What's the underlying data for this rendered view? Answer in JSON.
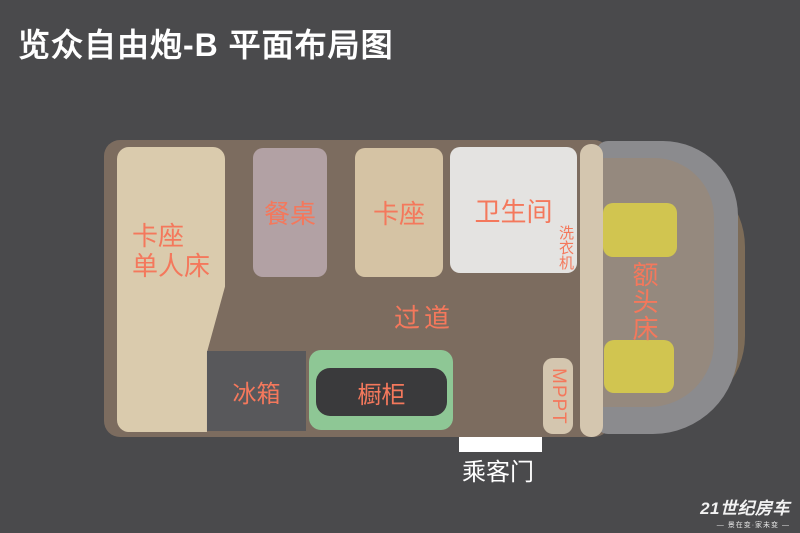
{
  "title": "览众自由炮-B 平面布局图",
  "colors": {
    "background": "#4a4a4c",
    "label_accent": "#f4785c",
    "body_brown": "#7c6c5f",
    "bed_beige": "#dacbad",
    "booth_beige": "#d5c3a4",
    "table_mauve": "#b2a1a4",
    "bathroom_white": "#e4e3e1",
    "fridge_gray": "#58585b",
    "cabinet_green": "#8ec795",
    "cabinet_inner_dark": "#3a3a3c",
    "partition_beige": "#d4c6af",
    "cab_gray": "#8b8b8e",
    "cab_floor": "#95897e",
    "cab_brown": "#7d6c58",
    "seat_yellow": "#d1c550",
    "door_white": "#ffffff"
  },
  "floorplan": {
    "bed": {
      "lines": [
        "卡座",
        "单人床"
      ]
    },
    "dining_table": {
      "label": "餐桌"
    },
    "booth": {
      "label": "卡座"
    },
    "bathroom": {
      "label": "卫生间",
      "washer_label": "洗衣机"
    },
    "aisle": {
      "label": "过道"
    },
    "fridge": {
      "label": "冰箱"
    },
    "cabinet": {
      "label": "橱柜"
    },
    "mppt": {
      "label": "MPPT"
    },
    "cab_bed": {
      "label": "额头床"
    },
    "passenger_door": {
      "label": "乘客门"
    }
  },
  "logo": {
    "brand": "21世纪房车",
    "tagline": "— 景在变·家未变 —"
  }
}
